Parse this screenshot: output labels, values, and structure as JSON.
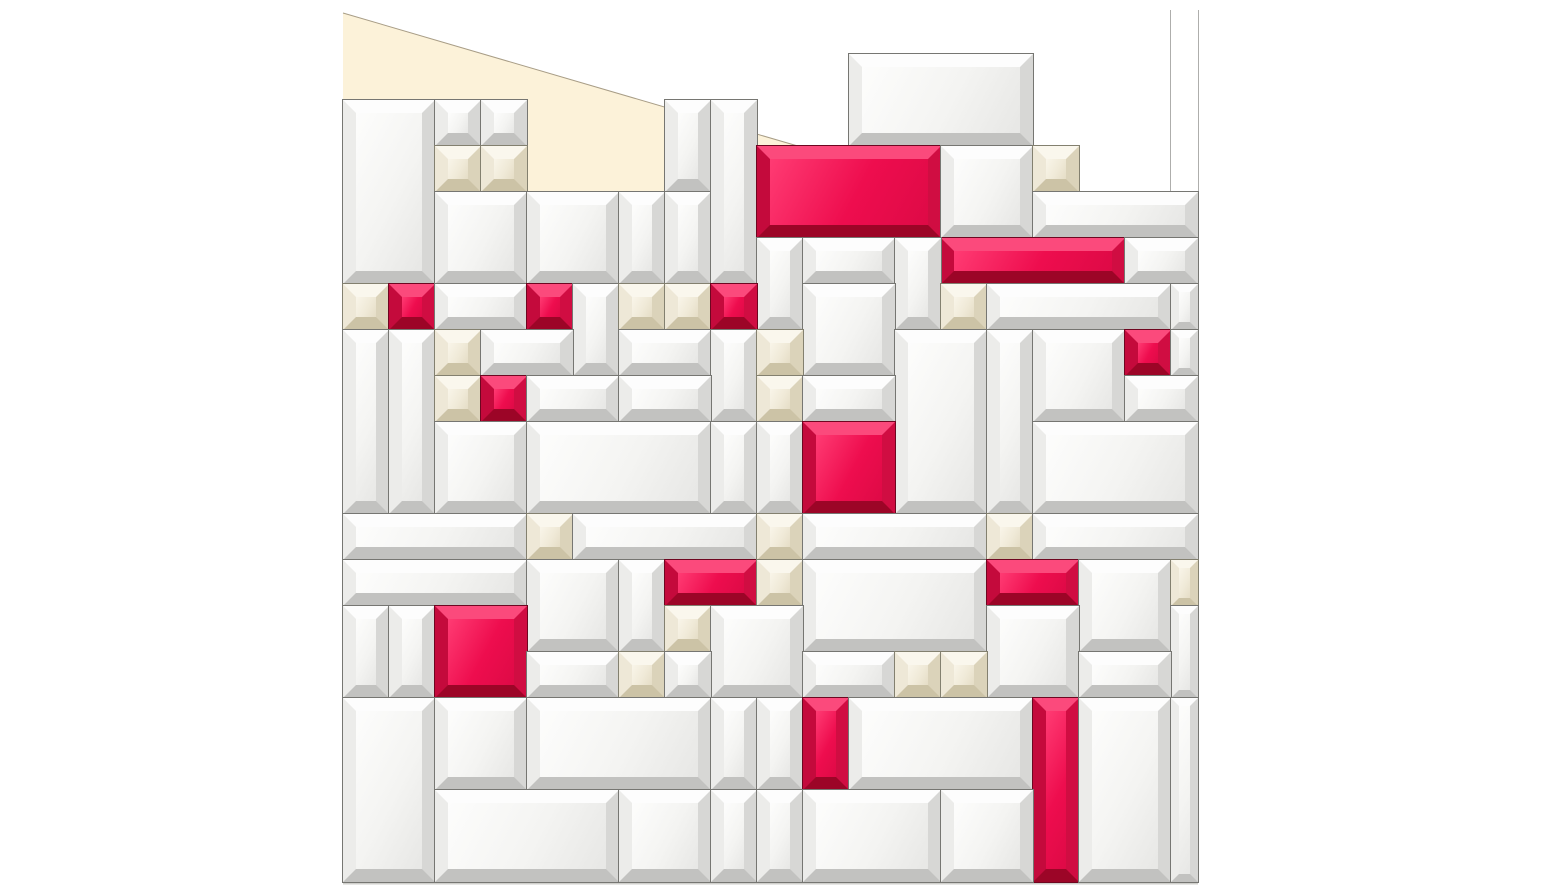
{
  "scene": {
    "canvas": {
      "width": 1542,
      "height": 895
    },
    "background_color": "#ffffff"
  },
  "wall": {
    "cream_patch": {
      "fill": "#fcf2d9",
      "polygon": [
        [
          343,
          13
        ],
        [
          808,
          149
        ],
        [
          665,
          149
        ],
        [
          665,
          193
        ],
        [
          527,
          193
        ],
        [
          527,
          149
        ],
        [
          343,
          149
        ]
      ]
    },
    "diagonal_edge": {
      "x1": 343,
      "y1": 13,
      "x2": 808,
      "y2": 149,
      "stroke": "#a89d86",
      "width": 1
    },
    "corner_lines": [
      {
        "x": 1170,
        "y1": 10,
        "y2": 196
      },
      {
        "x": 1198,
        "y1": 10,
        "y2": 200
      }
    ],
    "corner_line_color": "#aeaeac",
    "base_seam": {
      "x1": 343,
      "x2": 1198,
      "y": 883,
      "color": "#cfcfcb"
    }
  },
  "mosaic": {
    "origin": {
      "x": 343,
      "y": 54
    },
    "unit": 46,
    "palette": {
      "w": {
        "name": "white-mirror-tile",
        "face": "#f4f4f2",
        "sheen": "#fdfdfc",
        "shade": "#e7e7e5",
        "bevel_top": "#fdfdfd",
        "bevel_left": "#ececea",
        "bevel_right": "#d7d7d5",
        "bevel_bottom": "#c2c2c0",
        "seam": "#767672"
      },
      "i": {
        "name": "ivory-mirror-tile",
        "face": "#f0ead8",
        "sheen": "#f9f5e9",
        "shade": "#e5ddc6",
        "bevel_top": "#faf7ed",
        "bevel_left": "#eee8d7",
        "bevel_right": "#dbd3ba",
        "bevel_bottom": "#ccc3a6",
        "seam": "#83806f"
      },
      "r": {
        "name": "crimson-accent-tile",
        "face": "#ee0d4e",
        "sheen": "#ff3b73",
        "shade": "#de0a46",
        "bevel_top": "#fb4a7c",
        "bevel_left": "#c40a3c",
        "bevel_right": "#d00d42",
        "bevel_bottom": "#9c0527",
        "seam": "#6e0620"
      }
    },
    "tiles": [
      [
        0,
        1,
        2,
        4,
        "w"
      ],
      [
        2,
        1,
        1,
        1,
        "w"
      ],
      [
        3,
        1,
        1,
        1,
        "w"
      ],
      [
        2,
        2,
        1,
        1,
        "i"
      ],
      [
        3,
        2,
        1,
        1,
        "i"
      ],
      [
        2,
        3,
        2,
        2,
        "w"
      ],
      [
        4,
        3,
        2,
        2,
        "w"
      ],
      [
        6,
        3,
        1,
        2,
        "w"
      ],
      [
        7,
        1,
        1,
        2,
        "w"
      ],
      [
        7,
        3,
        1,
        2,
        "w"
      ],
      [
        8,
        1,
        1,
        4,
        "w"
      ],
      [
        11,
        0,
        4,
        2,
        "w"
      ],
      [
        9,
        2,
        4,
        2,
        "r"
      ],
      [
        13,
        2,
        2,
        2,
        "w"
      ],
      [
        15,
        2,
        1,
        1,
        "i"
      ],
      [
        15,
        3,
        3.587,
        1,
        "w"
      ],
      [
        13,
        4,
        4,
        1,
        "r"
      ],
      [
        17,
        4,
        1.587,
        1,
        "w"
      ],
      [
        9,
        4,
        1,
        2,
        "w"
      ],
      [
        10,
        4,
        2,
        1,
        "w"
      ],
      [
        12,
        4,
        1,
        2,
        "w"
      ],
      [
        0,
        5,
        1,
        1,
        "i"
      ],
      [
        1,
        5,
        1,
        1,
        "r"
      ],
      [
        2,
        5,
        2,
        1,
        "w"
      ],
      [
        4,
        5,
        1,
        1,
        "r"
      ],
      [
        5,
        5,
        1,
        2,
        "w"
      ],
      [
        6,
        5,
        1,
        1,
        "i"
      ],
      [
        7,
        5,
        1,
        1,
        "i"
      ],
      [
        8,
        5,
        1,
        1,
        "r"
      ],
      [
        10,
        5,
        2,
        2,
        "w"
      ],
      [
        13,
        5,
        1,
        1,
        "i"
      ],
      [
        14,
        5,
        4,
        1,
        "w"
      ],
      [
        18,
        5,
        0.587,
        1,
        "w"
      ],
      [
        0,
        6,
        1,
        4,
        "w"
      ],
      [
        1,
        6,
        1,
        4,
        "w"
      ],
      [
        2,
        6,
        1,
        1,
        "i"
      ],
      [
        3,
        6,
        2,
        1,
        "w"
      ],
      [
        6,
        6,
        2,
        1,
        "w"
      ],
      [
        8,
        6,
        1,
        2,
        "w"
      ],
      [
        9,
        6,
        1,
        1,
        "i"
      ],
      [
        9,
        7,
        1,
        1,
        "i"
      ],
      [
        12,
        6,
        2,
        4,
        "w"
      ],
      [
        14,
        6,
        1,
        4,
        "w"
      ],
      [
        15,
        6,
        2,
        2,
        "w"
      ],
      [
        17,
        6,
        1,
        1,
        "r"
      ],
      [
        18,
        6,
        0.587,
        1,
        "w"
      ],
      [
        2,
        7,
        1,
        1,
        "i"
      ],
      [
        3,
        7,
        1,
        1,
        "r"
      ],
      [
        4,
        7,
        2,
        1,
        "w"
      ],
      [
        6,
        7,
        2,
        1,
        "w"
      ],
      [
        10,
        7,
        2,
        1,
        "w"
      ],
      [
        17,
        7,
        1.587,
        1,
        "w"
      ],
      [
        2,
        8,
        2,
        2,
        "w"
      ],
      [
        4,
        8,
        4,
        2,
        "w"
      ],
      [
        8,
        8,
        1,
        2,
        "w"
      ],
      [
        9,
        8,
        1,
        2,
        "w"
      ],
      [
        10,
        8,
        2,
        2,
        "r"
      ],
      [
        15,
        8,
        3.587,
        2,
        "w"
      ],
      [
        0,
        10,
        4,
        1,
        "w"
      ],
      [
        4,
        10,
        1,
        1,
        "i"
      ],
      [
        5,
        10,
        4,
        1,
        "w"
      ],
      [
        9,
        10,
        1,
        1,
        "i"
      ],
      [
        10,
        10,
        4,
        1,
        "w"
      ],
      [
        14,
        10,
        1,
        1,
        "i"
      ],
      [
        15,
        10,
        3.587,
        1,
        "w"
      ],
      [
        0,
        11,
        4,
        1,
        "w"
      ],
      [
        4,
        11,
        2,
        2,
        "w"
      ],
      [
        6,
        11,
        1,
        2,
        "w"
      ],
      [
        7,
        11,
        2,
        1,
        "r"
      ],
      [
        9,
        11,
        1,
        1,
        "i"
      ],
      [
        10,
        11,
        4,
        2,
        "w"
      ],
      [
        14,
        11,
        2,
        1,
        "r"
      ],
      [
        16,
        11,
        2,
        2,
        "w"
      ],
      [
        18,
        11,
        0.587,
        1,
        "i"
      ],
      [
        0,
        12,
        1,
        2,
        "w"
      ],
      [
        1,
        12,
        1,
        2,
        "w"
      ],
      [
        2,
        12,
        2,
        2,
        "r"
      ],
      [
        7,
        12,
        1,
        1,
        "i"
      ],
      [
        8,
        12,
        2,
        2,
        "w"
      ],
      [
        14,
        12,
        2,
        2,
        "w"
      ],
      [
        18,
        12,
        0.587,
        2,
        "w"
      ],
      [
        4,
        13,
        2,
        1,
        "w"
      ],
      [
        6,
        13,
        1,
        1,
        "i"
      ],
      [
        7,
        13,
        1,
        1,
        "w"
      ],
      [
        10,
        13,
        2,
        1,
        "w"
      ],
      [
        12,
        13,
        1,
        1,
        "i"
      ],
      [
        13,
        13,
        1,
        1,
        "i"
      ],
      [
        16,
        13,
        2,
        1,
        "w"
      ],
      [
        0,
        14,
        2,
        4,
        "w"
      ],
      [
        2,
        14,
        2,
        2,
        "w"
      ],
      [
        4,
        14,
        4,
        2,
        "w"
      ],
      [
        8,
        14,
        1,
        2,
        "w"
      ],
      [
        9,
        14,
        1,
        2,
        "w"
      ],
      [
        10,
        14,
        1,
        2,
        "r"
      ],
      [
        11,
        14,
        4,
        2,
        "w"
      ],
      [
        15,
        14,
        1,
        4,
        "r"
      ],
      [
        16,
        14,
        2,
        4,
        "w"
      ],
      [
        18,
        14,
        0.587,
        4,
        "w"
      ],
      [
        2,
        16,
        4,
        2,
        "w"
      ],
      [
        6,
        16,
        2,
        2,
        "w"
      ],
      [
        8,
        16,
        1,
        2,
        "w"
      ],
      [
        9,
        16,
        1,
        2,
        "w"
      ],
      [
        10,
        16,
        3,
        2,
        "w"
      ],
      [
        13,
        16,
        2,
        2,
        "w"
      ]
    ]
  }
}
